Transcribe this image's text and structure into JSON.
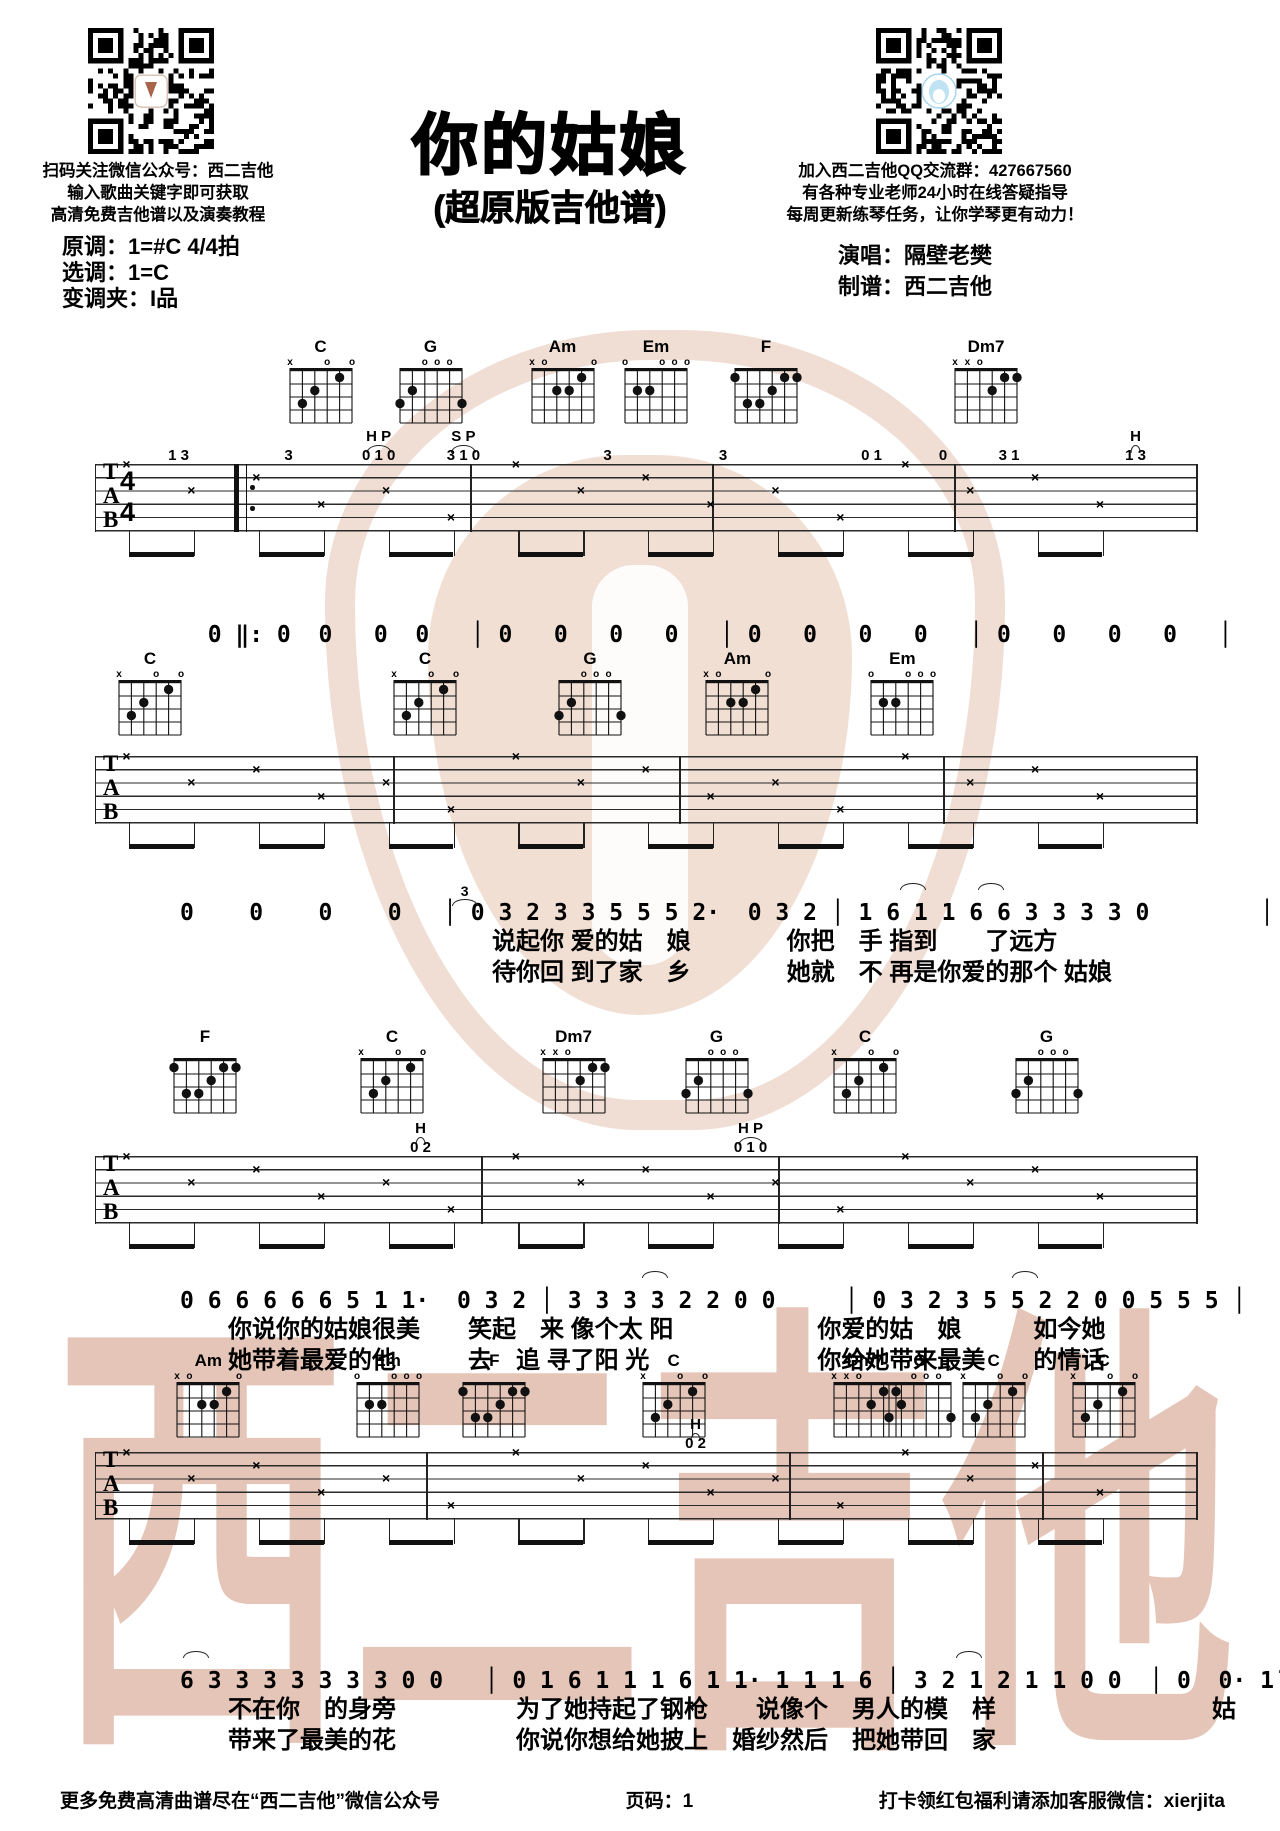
{
  "header": {
    "title": "你的姑娘",
    "subtitle": "(超原版吉他谱)",
    "left_qr_caption": [
      "扫码关注微信公众号：西二吉他",
      "输入歌曲关键字即可获取",
      "高清免费吉他谱以及演奏教程"
    ],
    "right_qr_caption": [
      "加入西二吉他QQ交流群：427667560",
      "有各种专业老师24小时在线答疑指导",
      "每周更新练琴任务，让你学琴更有动力！"
    ],
    "key_info": [
      "原调：1=#C  4/4拍",
      "选调：1=C",
      "变调夹：I品"
    ],
    "credits": [
      "演唱：隔壁老樊",
      "制谱：西二吉他"
    ]
  },
  "watermark": {
    "text": "西二吉他"
  },
  "music": {
    "clef": [
      "T",
      "A",
      "B"
    ],
    "time_signature": [
      "4",
      "4"
    ],
    "strum_glyph": "×",
    "chord_shapes": {
      "C": {
        "markers": [
          "x",
          "",
          "",
          "o",
          "",
          "o"
        ],
        "dots": [
          [
            1,
            3
          ],
          [
            2,
            2
          ],
          [
            4,
            1
          ]
        ]
      },
      "G": {
        "markers": [
          "",
          "",
          "o",
          "o",
          "o",
          ""
        ],
        "dots": [
          [
            0,
            3
          ],
          [
            1,
            2
          ],
          [
            5,
            3
          ]
        ]
      },
      "Am": {
        "markers": [
          "x",
          "o",
          "",
          "",
          "",
          "o"
        ],
        "dots": [
          [
            2,
            2
          ],
          [
            3,
            2
          ],
          [
            4,
            1
          ]
        ]
      },
      "Em": {
        "markers": [
          "o",
          "",
          "",
          "o",
          "o",
          "o"
        ],
        "dots": [
          [
            1,
            2
          ],
          [
            2,
            2
          ]
        ]
      },
      "F": {
        "markers": [
          "",
          "",
          "",
          "",
          "",
          ""
        ],
        "dots": [
          [
            0,
            1
          ],
          [
            4,
            1
          ],
          [
            5,
            1
          ],
          [
            3,
            2
          ],
          [
            1,
            3
          ],
          [
            2,
            3
          ]
        ]
      },
      "Dm7": {
        "markers": [
          "x",
          "x",
          "o",
          "",
          "",
          ""
        ],
        "dots": [
          [
            3,
            2
          ],
          [
            4,
            1
          ],
          [
            5,
            1
          ]
        ]
      }
    },
    "systems": [
      {
        "chords": [
          {
            "name": "C",
            "pos": 20.5
          },
          {
            "name": "G",
            "pos": 30.5
          },
          {
            "name": "Am",
            "pos": 42.5
          },
          {
            "name": "Em",
            "pos": 51
          },
          {
            "name": "F",
            "pos": 61
          },
          {
            "name": "Dm7",
            "pos": 81
          }
        ],
        "annotations": [
          {
            "text": "1 3",
            "x": 7.5,
            "row": 2
          },
          {
            "text": "3",
            "x": 17.5,
            "row": 2
          },
          {
            "text": "H P",
            "x": 25.7,
            "row": 1
          },
          {
            "text": "0 1 0",
            "x": 25.7,
            "row": 2
          },
          {
            "text": "S P",
            "x": 33.4,
            "row": 1
          },
          {
            "text": "3 1 0",
            "x": 33.4,
            "row": 2
          },
          {
            "text": "3",
            "x": 46.5,
            "row": 2
          },
          {
            "text": "3",
            "x": 57,
            "row": 2
          },
          {
            "text": "0 1",
            "x": 70.5,
            "row": 2
          },
          {
            "text": "0",
            "x": 77,
            "row": 2
          },
          {
            "text": "3 1",
            "x": 83,
            "row": 2
          },
          {
            "text": "H",
            "x": 94.5,
            "row": 1
          },
          {
            "text": "1 3",
            "x": 94.5,
            "row": 2
          }
        ]
      },
      {
        "chords": [
          {
            "name": "C",
            "pos": 5
          },
          {
            "name": "C",
            "pos": 30
          },
          {
            "name": "G",
            "pos": 45
          },
          {
            "name": "Am",
            "pos": 58.4
          },
          {
            "name": "Em",
            "pos": 73.4
          }
        ],
        "annotations": []
      },
      {
        "chords": [
          {
            "name": "F",
            "pos": 10
          },
          {
            "name": "C",
            "pos": 27
          },
          {
            "name": "Dm7",
            "pos": 43.5
          },
          {
            "name": "G",
            "pos": 56.5
          },
          {
            "name": "C",
            "pos": 70
          },
          {
            "name": "G",
            "pos": 86.5
          }
        ],
        "annotations": [
          {
            "text": "H",
            "x": 29.5,
            "row": 1
          },
          {
            "text": "0 2",
            "x": 29.5,
            "row": 2
          },
          {
            "text": "H P",
            "x": 59.5,
            "row": 1
          },
          {
            "text": "0 1 0",
            "x": 59.5,
            "row": 2
          }
        ]
      },
      {
        "chords": [
          {
            "name": "Am",
            "pos": 10.3
          },
          {
            "name": "Em",
            "pos": 26.6
          },
          {
            "name": "F",
            "pos": 36.3
          },
          {
            "name": "C",
            "pos": 52.6
          },
          {
            "name": "Dm7",
            "pos": 70
          },
          {
            "name": "G",
            "pos": 75
          },
          {
            "name": "C",
            "pos": 81.7
          },
          {
            "name": "C",
            "pos": 91.7
          }
        ],
        "annotations": [
          {
            "text": "H",
            "x": 54.5,
            "row": 1
          },
          {
            "text": "0 2",
            "x": 54.5,
            "row": 2
          }
        ]
      }
    ],
    "vocal_rows": [
      {
        "numbers": "  0 ‖: 0  0   0  0   │ 0   0   0   0   │ 0   0   0   0   │ 0   0   0   0   │",
        "lyrics": [],
        "annotations": []
      },
      {
        "numbers": "0    0    0    0   │ 0 3 2 3 3 5 5 5 2·  0 3 2 │ 1 6 1 1 6 6 3 3 3 3 0        │",
        "lyrics": [
          "　　　　　　　　　　　　　说起你 爱的姑　娘　　　　你把　手 指到　　了远方",
          "　　　　　　　　　　　　　待你回 到了家　乡　　　　她就　不 再是你爱的那个 姑娘"
        ],
        "annotations": [
          {
            "text": "3",
            "x": 33
          },
          {
            "text": "",
            "x": 73
          },
          {
            "text": "",
            "x": 80
          }
        ]
      },
      {
        "numbers": "0 6 6 6 6 6 5 1 1·  0 3 2 │ 3 3 3 3 2 2 0 0     │ 0 3 2 3 5 5 2 2 0 0 5 5 5 │",
        "lyrics": [
          "　　你说你的姑娘很美　　笑起　来 像个太 阳　　　　　　你爱的姑　娘　　　如今她",
          "　　她带着最爱的他　　　去　追 寻了阳 光　　　　　　　你给她带来最美　　的情话"
        ],
        "annotations": [
          {
            "text": "",
            "x": 50
          },
          {
            "text": "",
            "x": 83
          }
        ]
      },
      {
        "numbers": "6 3 3 3 3 3 3 3 0 0   │ 0 1 6 1 1 1 6 1 1· 1 1 1 6 │ 3 2 1 2 1 1 0 0  │ 0  0· 1̇ │",
        "lyrics": [
          "　　不在你　的身旁　　　　　为了她持起了钢枪　　说像个　男人的模　样　　　　　　　　　姑",
          "　　带来了最美的花　　　　　你说你想给她披上　婚纱然后　把她带回　家"
        ],
        "annotations": [
          {
            "text": "",
            "x": 9
          },
          {
            "text": "",
            "x": 78
          }
        ]
      }
    ]
  },
  "footer": {
    "left": "更多免费高清曲谱尽在“西二吉他”微信公众号",
    "center": "页码：1",
    "right": "打卡领红包福利请添加客服微信：xierjita"
  }
}
